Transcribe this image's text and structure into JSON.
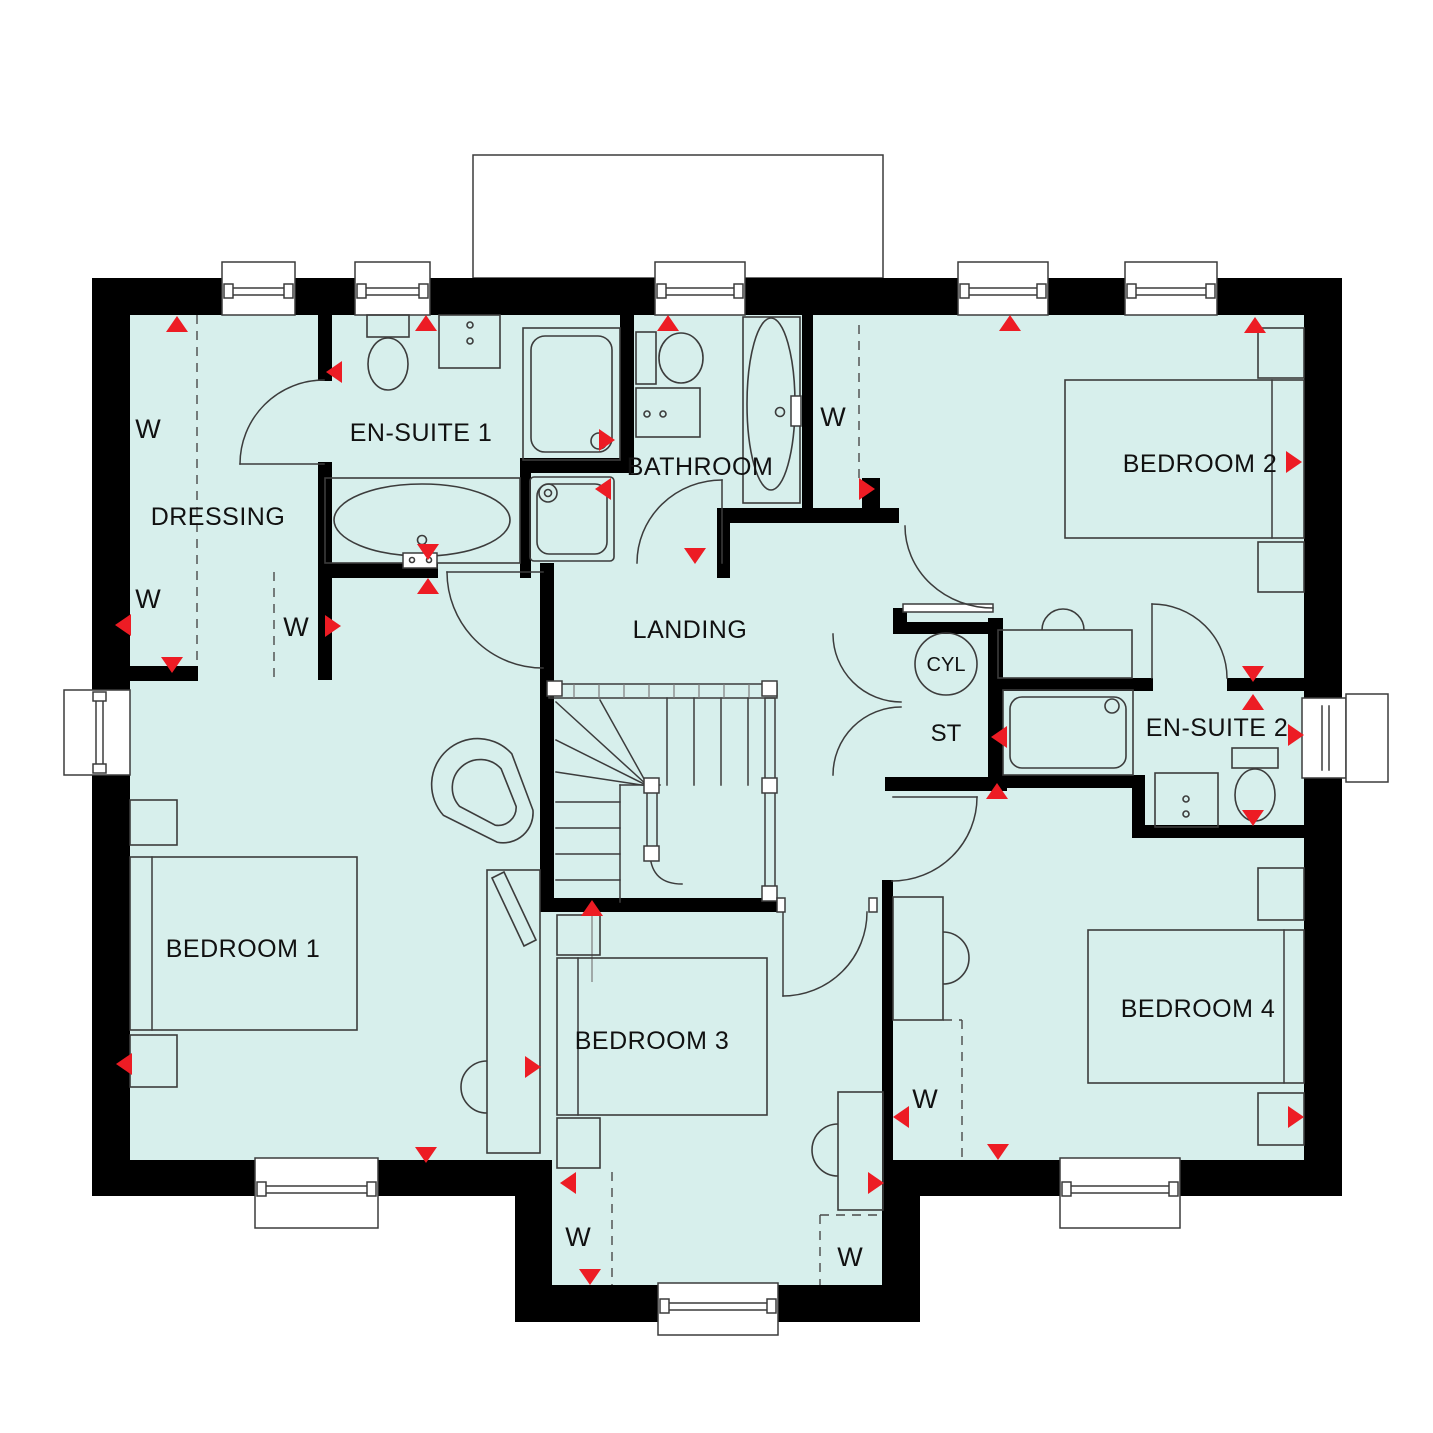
{
  "plan_type": "floor-plan",
  "colors": {
    "floor": "#d7efec",
    "wall": "#000000",
    "outline": "#3c3c3c",
    "marker_red": "#ed1c24"
  },
  "rooms": {
    "dressing": {
      "label": "DRESSING"
    },
    "ensuite1": {
      "label": "EN-SUITE 1"
    },
    "bathroom": {
      "label": "BATHROOM"
    },
    "bedroom2": {
      "label": "BEDROOM 2"
    },
    "landing": {
      "label": "LANDING"
    },
    "cylinder": {
      "label": "CYL"
    },
    "store": {
      "label": "ST"
    },
    "ensuite2": {
      "label": "EN-SUITE 2"
    },
    "bedroom1": {
      "label": "BEDROOM 1"
    },
    "bedroom3": {
      "label": "BEDROOM 3"
    },
    "bedroom4": {
      "label": "BEDROOM 4"
    }
  },
  "wardrobe_labels": [
    {
      "label": "W",
      "x": 148,
      "y": 438
    },
    {
      "label": "W",
      "x": 148,
      "y": 608
    },
    {
      "label": "W",
      "x": 296,
      "y": 636
    },
    {
      "label": "W",
      "x": 833,
      "y": 426
    },
    {
      "label": "W",
      "x": 578,
      "y": 1246
    },
    {
      "label": "W",
      "x": 850,
      "y": 1266
    },
    {
      "label": "W",
      "x": 925,
      "y": 1108
    }
  ],
  "markers": [
    {
      "dir": "up",
      "x": 177,
      "y": 324
    },
    {
      "dir": "up",
      "x": 426,
      "y": 323
    },
    {
      "dir": "up",
      "x": 668,
      "y": 323
    },
    {
      "dir": "up",
      "x": 1010,
      "y": 323
    },
    {
      "dir": "up",
      "x": 1255,
      "y": 325
    },
    {
      "dir": "left",
      "x": 334,
      "y": 372
    },
    {
      "dir": "right",
      "x": 1294,
      "y": 462
    },
    {
      "dir": "left",
      "x": 123,
      "y": 625
    },
    {
      "dir": "down",
      "x": 172,
      "y": 665
    },
    {
      "dir": "right",
      "x": 333,
      "y": 626
    },
    {
      "dir": "right",
      "x": 607,
      "y": 440
    },
    {
      "dir": "left",
      "x": 603,
      "y": 489
    },
    {
      "dir": "down",
      "x": 695,
      "y": 556
    },
    {
      "dir": "right",
      "x": 867,
      "y": 489
    },
    {
      "dir": "down",
      "x": 428,
      "y": 552
    },
    {
      "dir": "up",
      "x": 428,
      "y": 586
    },
    {
      "dir": "down",
      "x": 1253,
      "y": 674
    },
    {
      "dir": "up",
      "x": 1253,
      "y": 702
    },
    {
      "dir": "right",
      "x": 1296,
      "y": 735
    },
    {
      "dir": "down",
      "x": 1253,
      "y": 818
    },
    {
      "dir": "left",
      "x": 999,
      "y": 737
    },
    {
      "dir": "up",
      "x": 997,
      "y": 791
    },
    {
      "dir": "up",
      "x": 592,
      "y": 908
    },
    {
      "dir": "left",
      "x": 568,
      "y": 1183
    },
    {
      "dir": "down",
      "x": 590,
      "y": 1277
    },
    {
      "dir": "right",
      "x": 876,
      "y": 1183
    },
    {
      "dir": "left",
      "x": 901,
      "y": 1117
    },
    {
      "dir": "down",
      "x": 998,
      "y": 1152
    },
    {
      "dir": "right",
      "x": 1296,
      "y": 1117
    },
    {
      "dir": "down",
      "x": 426,
      "y": 1155
    },
    {
      "dir": "left",
      "x": 124,
      "y": 1064
    },
    {
      "dir": "right",
      "x": 533,
      "y": 1067
    }
  ]
}
